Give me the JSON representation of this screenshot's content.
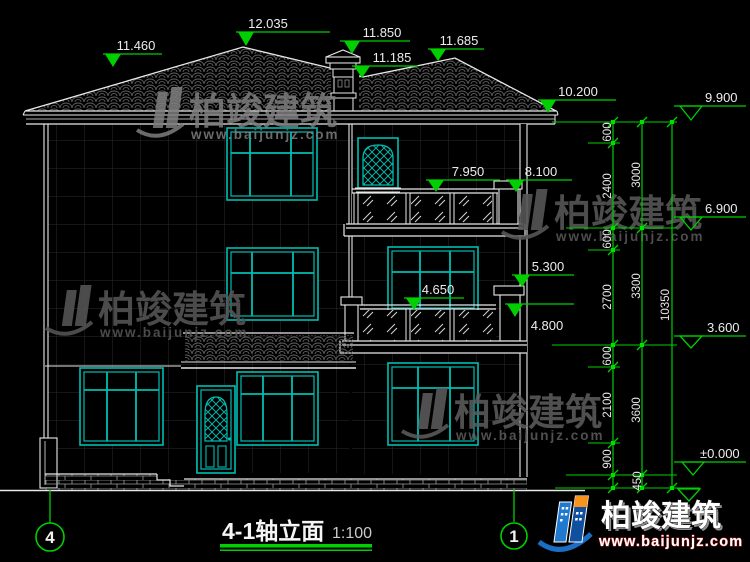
{
  "drawing_type": "architectural-elevation-cad",
  "title_block": {
    "title": "4-1轴立面",
    "scale": "1:100"
  },
  "axis_markers": {
    "left": "4",
    "right": "1"
  },
  "elevation_flags": {
    "f11460": "11.460",
    "f12035": "12.035",
    "f11850": "11.850",
    "f11185": "11.185",
    "f11685": "11.685",
    "f10200": "10.200",
    "f8100": "8.100",
    "f7950": "7.950",
    "f5300": "5.300",
    "f4650": "4.650",
    "f4800": "4.800"
  },
  "datum_flags": {
    "f9900": "9.900",
    "f6900": "6.900",
    "f3600": "3.600",
    "f0000": "±0.000"
  },
  "dimension_chains": {
    "inner": [
      "600",
      "2400",
      "600",
      "2700",
      "600",
      "2100",
      "900"
    ],
    "middle": [
      "3000",
      "3300",
      "3600"
    ],
    "shared_bottom": "450",
    "overall": "10350"
  },
  "watermark": {
    "brand": "柏竣建筑",
    "url": "www.baijunjz.com"
  },
  "logo": {
    "brand": "柏竣建筑",
    "url": "www.baijunjz.com"
  },
  "colors": {
    "background": "#000000",
    "dimension_green": "#00cf00",
    "window_teal": "#00bdb2",
    "line_white": "#e8e8e8",
    "watermark_gray": "#6f6f6f",
    "logo_blue": "#1e79cf",
    "logo_orange": "#f7941d"
  }
}
